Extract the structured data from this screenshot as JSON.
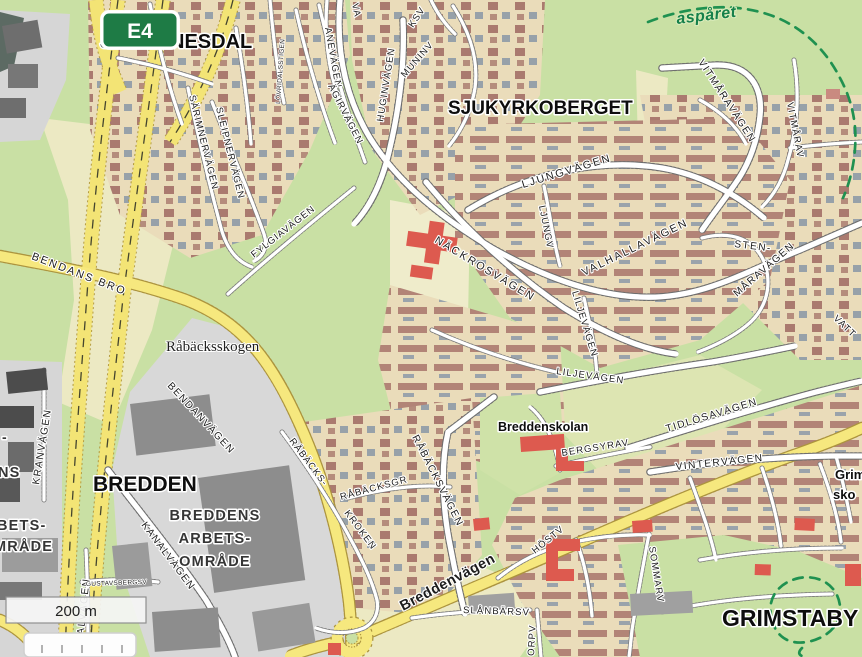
{
  "map": {
    "misc": {
      "shield": "E4",
      "scale": "200 m",
      "trail": "aspåret"
    },
    "colors": {
      "forest_green": "#c9e0a4",
      "open_cream": "#ece9c3",
      "residential_tan": "#eadcba",
      "house_red_brown": "#aa7a6f",
      "major_road_yellow": "#f6e87e",
      "industrial_gray": "#8d8d8d",
      "public_building_red": "#dd5a4f",
      "trail_green": "#1f9150",
      "shield_green": "#1e7b45"
    },
    "areas": {
      "johannesdal": "JOHANNESDAL",
      "sjukyrkoberget": "SJUKYRKOBERGET",
      "bredden": "BREDDEN",
      "grimstaby": "GRIMSTABY",
      "rabacksskogen": "Råbäcksskogen",
      "breddens_l1": "BREDDENS",
      "breddens_l2": "ARBETS-",
      "breddens_l3": "OMRÅDE",
      "breddenskolan": "Breddenskolan",
      "school_l1": "Grim",
      "school_l2": "sko",
      "edge_l0": "-",
      "edge_l1": "NS",
      "edge_l2": "BETS-",
      "edge_l3": "MRÅDE"
    },
    "streets": {
      "ane": "ANEVÄGEN",
      "agir": "ÄGIRVÄGEN",
      "hugin": "HUGINVÄGEN",
      "munin": "MUNINV",
      "ksv": "KSV",
      "va": "VA",
      "lovridal": "LÖVRIDALSSTIGEN",
      "sarimner": "SÄRIMNERVÄGEN",
      "sleipner": "SLEIPNERVÄGEN",
      "fylgia": "FYLGIAVÄGEN",
      "nackros": "NÄCKROSVÄGEN",
      "ljung": "LJUNGVÄGEN",
      "ljungv": "LJUNGV",
      "valhalla": "VALHALLAVÄGEN",
      "lilje_v": "LILJEVÄGEN",
      "lilje_h": "LILJEVÄGEN",
      "vitmara": "VITMÅRAVÄGEN",
      "vitmarav": "VITMÅRAV",
      "sten": "STEN-",
      "mara": "MÅRAVÄGEN",
      "vatt": "VATT",
      "tidlosa": "TIDLÖSAVÄGEN",
      "bergsyra": "BERGSYRAV",
      "vinter": "VINTERVÄGEN",
      "host": "HÖSTV",
      "sommar": "SOMMARV",
      "slanbar": "SLÅNBÄRSV",
      "orp": "ORPV",
      "rabacks_a": "RÅBÄCKS-",
      "rabacks_b": "KROKEN",
      "rabacksgr": "RÅBÄCKSGR",
      "rabacksv": "RÅBÄCKSVÄGEN",
      "kran": "KRANVÄGEN",
      "kanal_d": "KANALVÄGEN",
      "kanal_v": "KANALVÄGEN",
      "gastav": "GUSTAVSBERGSV",
      "bendans_bro": "BENDANS BRO",
      "bendan": "BENDANVÄGEN",
      "breddenv": "Breddenvägen"
    }
  }
}
